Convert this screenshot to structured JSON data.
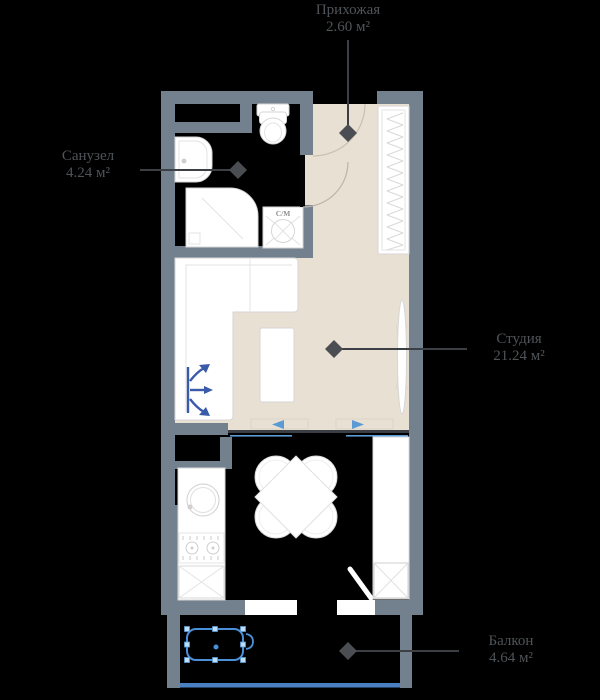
{
  "rooms": {
    "hallway": {
      "label": "Прихожая",
      "area": "2.60 м²"
    },
    "bathroom": {
      "label": "Санузел",
      "area": "4.24 м²"
    },
    "studio": {
      "label": "Студия",
      "area": "21.24 м²"
    },
    "balcony": {
      "label": "Балкон",
      "area": "4.64 м²"
    }
  },
  "annotations": {
    "washing_machine": "С/М"
  },
  "colors": {
    "background": "#000000",
    "wall": "#73808D",
    "floor_light": "#E8E0D3",
    "floor_dark": "#000000",
    "furniture_fill": "#FFFFFF",
    "furniture_stroke": "#D6D6D6",
    "label_text": "#4F5458",
    "leader_line": "#3C3F43",
    "diamond_marker": "#4A4E53",
    "sofa_arrow_blue": "#3A5BA9",
    "sliding_door_blue": "#5B9BD5",
    "selection_blue": "#4A90D9",
    "glazing_blue": "#4A7FC1"
  }
}
